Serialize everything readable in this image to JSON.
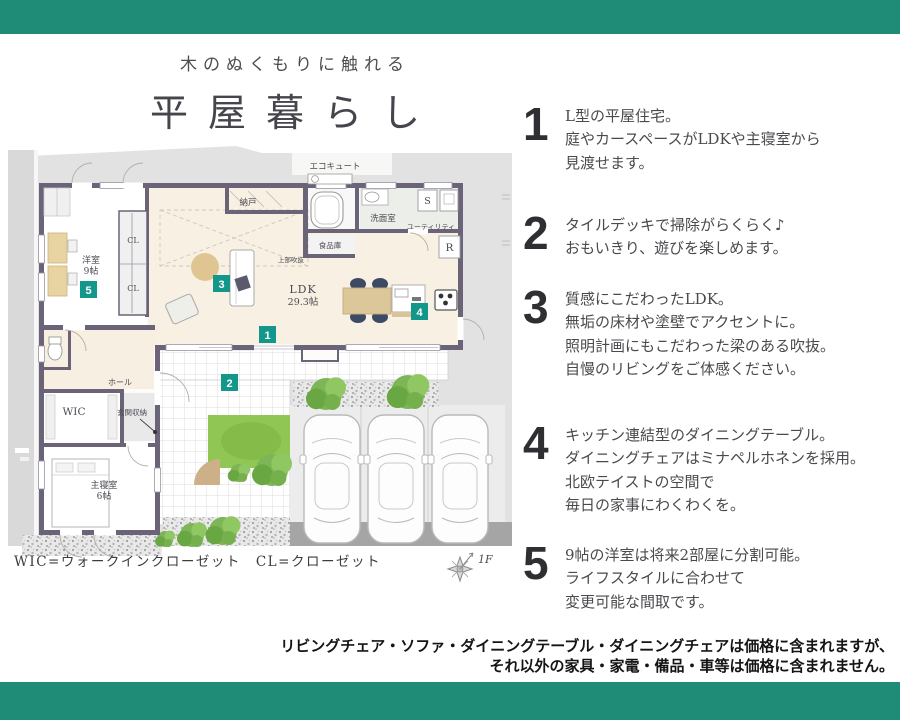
{
  "colors": {
    "band_teal": "#1e8c76",
    "marker_teal": "#12978a",
    "wall_purple": "#6b6378",
    "floor_cream": "#f8f0e2",
    "wood": "#e8d3a2",
    "lawn_green": "#90c653"
  },
  "header": {
    "subtitle": "木のぬくもりに触れる",
    "title": "平屋暮らし"
  },
  "floorplan": {
    "labels": {
      "ecocute": "エコキュート",
      "nando": "納戸",
      "senmenshitsu": "洗面室",
      "utility": "ユーティリティ",
      "pantry": "食品庫",
      "ldk": "LDK",
      "ldk_size": "29.3帖",
      "void": "上部吹抜",
      "cl_upper": "CL",
      "cl_lower": "CL",
      "yoshitsu": "洋室",
      "yoshitsu_size": "9帖",
      "wic": "WIC",
      "hall": "ホール",
      "genkan_storage": "玄関収納",
      "shushinshitsu": "主寝室",
      "shushinshitsu_size": "6帖",
      "s": "S",
      "r": "R"
    },
    "markers": [
      "1",
      "2",
      "3",
      "4",
      "5"
    ],
    "legend": "WIC=ウォークインクローゼット　CL=クローゼット",
    "floor_tag": "1F"
  },
  "features": [
    {
      "num": "1",
      "lines": [
        "L型の平屋住宅。",
        "庭やカースペースがLDKや主寝室から",
        "見渡せます。"
      ]
    },
    {
      "num": "2",
      "lines": [
        "タイルデッキで掃除がらくらく♪",
        "おもいきり、遊びを楽しめます。"
      ]
    },
    {
      "num": "3",
      "lines": [
        "質感にこだわったLDK。",
        "無垢の床材や塗壁でアクセントに。",
        "照明計画にもこだわった梁のある吹抜。",
        "自慢のリビングをご体感ください。"
      ]
    },
    {
      "num": "4",
      "lines": [
        "キッチン連結型のダイニングテーブル。",
        "ダイニングチェアはミナペルホネンを採用。",
        "北欧テイストの空間で",
        "毎日の家事にわくわくを。"
      ]
    },
    {
      "num": "5",
      "lines": [
        "9帖の洋室は将来2部屋に分割可能。",
        "ライフスタイルに合わせて",
        "変更可能な間取です。"
      ]
    }
  ],
  "disclaimer": [
    "リビングチェア・ソファ・ダイニングテーブル・ダイニングチェアは価格に含まれますが、",
    "それ以外の家具・家電・備品・車等は価格に含まれません。"
  ]
}
